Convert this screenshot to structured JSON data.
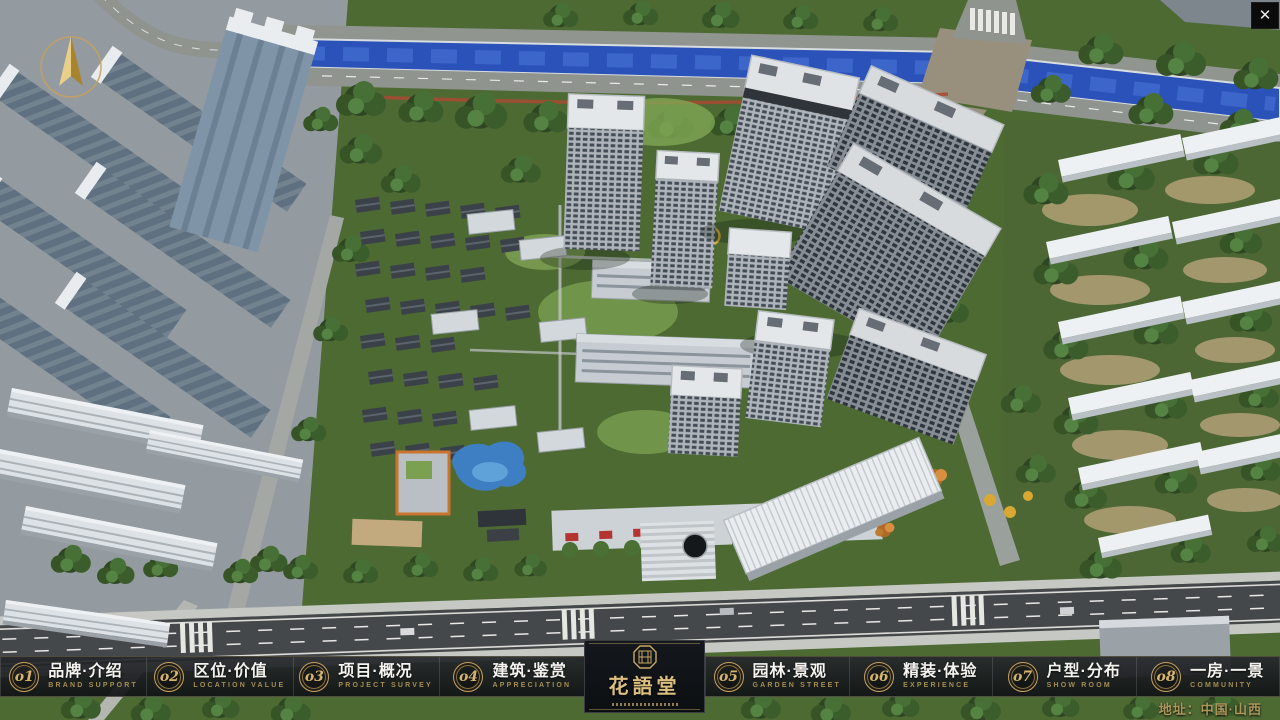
{
  "window": {
    "close_glyph": "✕"
  },
  "menu": {
    "items": [
      {
        "num": "o1",
        "label": "品牌·介绍",
        "sub": "BRAND SUPPORT"
      },
      {
        "num": "o2",
        "label": "区位·价值",
        "sub": "LOCATION VALUE"
      },
      {
        "num": "o3",
        "label": "项目·概况",
        "sub": "PROJECT SURVEY"
      },
      {
        "num": "o4",
        "label": "建筑·鉴赏",
        "sub": "APPRECIATION"
      },
      {
        "num": "o5",
        "label": "园林·景观",
        "sub": "GARDEN STREET"
      },
      {
        "num": "o6",
        "label": "精装·体验",
        "sub": "EXPERIENCE"
      },
      {
        "num": "o7",
        "label": "户型·分布",
        "sub": "SHOW ROOM"
      },
      {
        "num": "o8",
        "label": "一房·一景",
        "sub": "COMMUNITY"
      }
    ]
  },
  "logo": {
    "title": "花語堂"
  },
  "footer": {
    "address": "地址：中国·山西"
  },
  "colors": {
    "gold_accent": "#c9a863",
    "gold_dim": "#a58d52",
    "bar_background": "#16181a",
    "river_blue": "#2b52b8",
    "label_white": "#f4f3ef"
  }
}
